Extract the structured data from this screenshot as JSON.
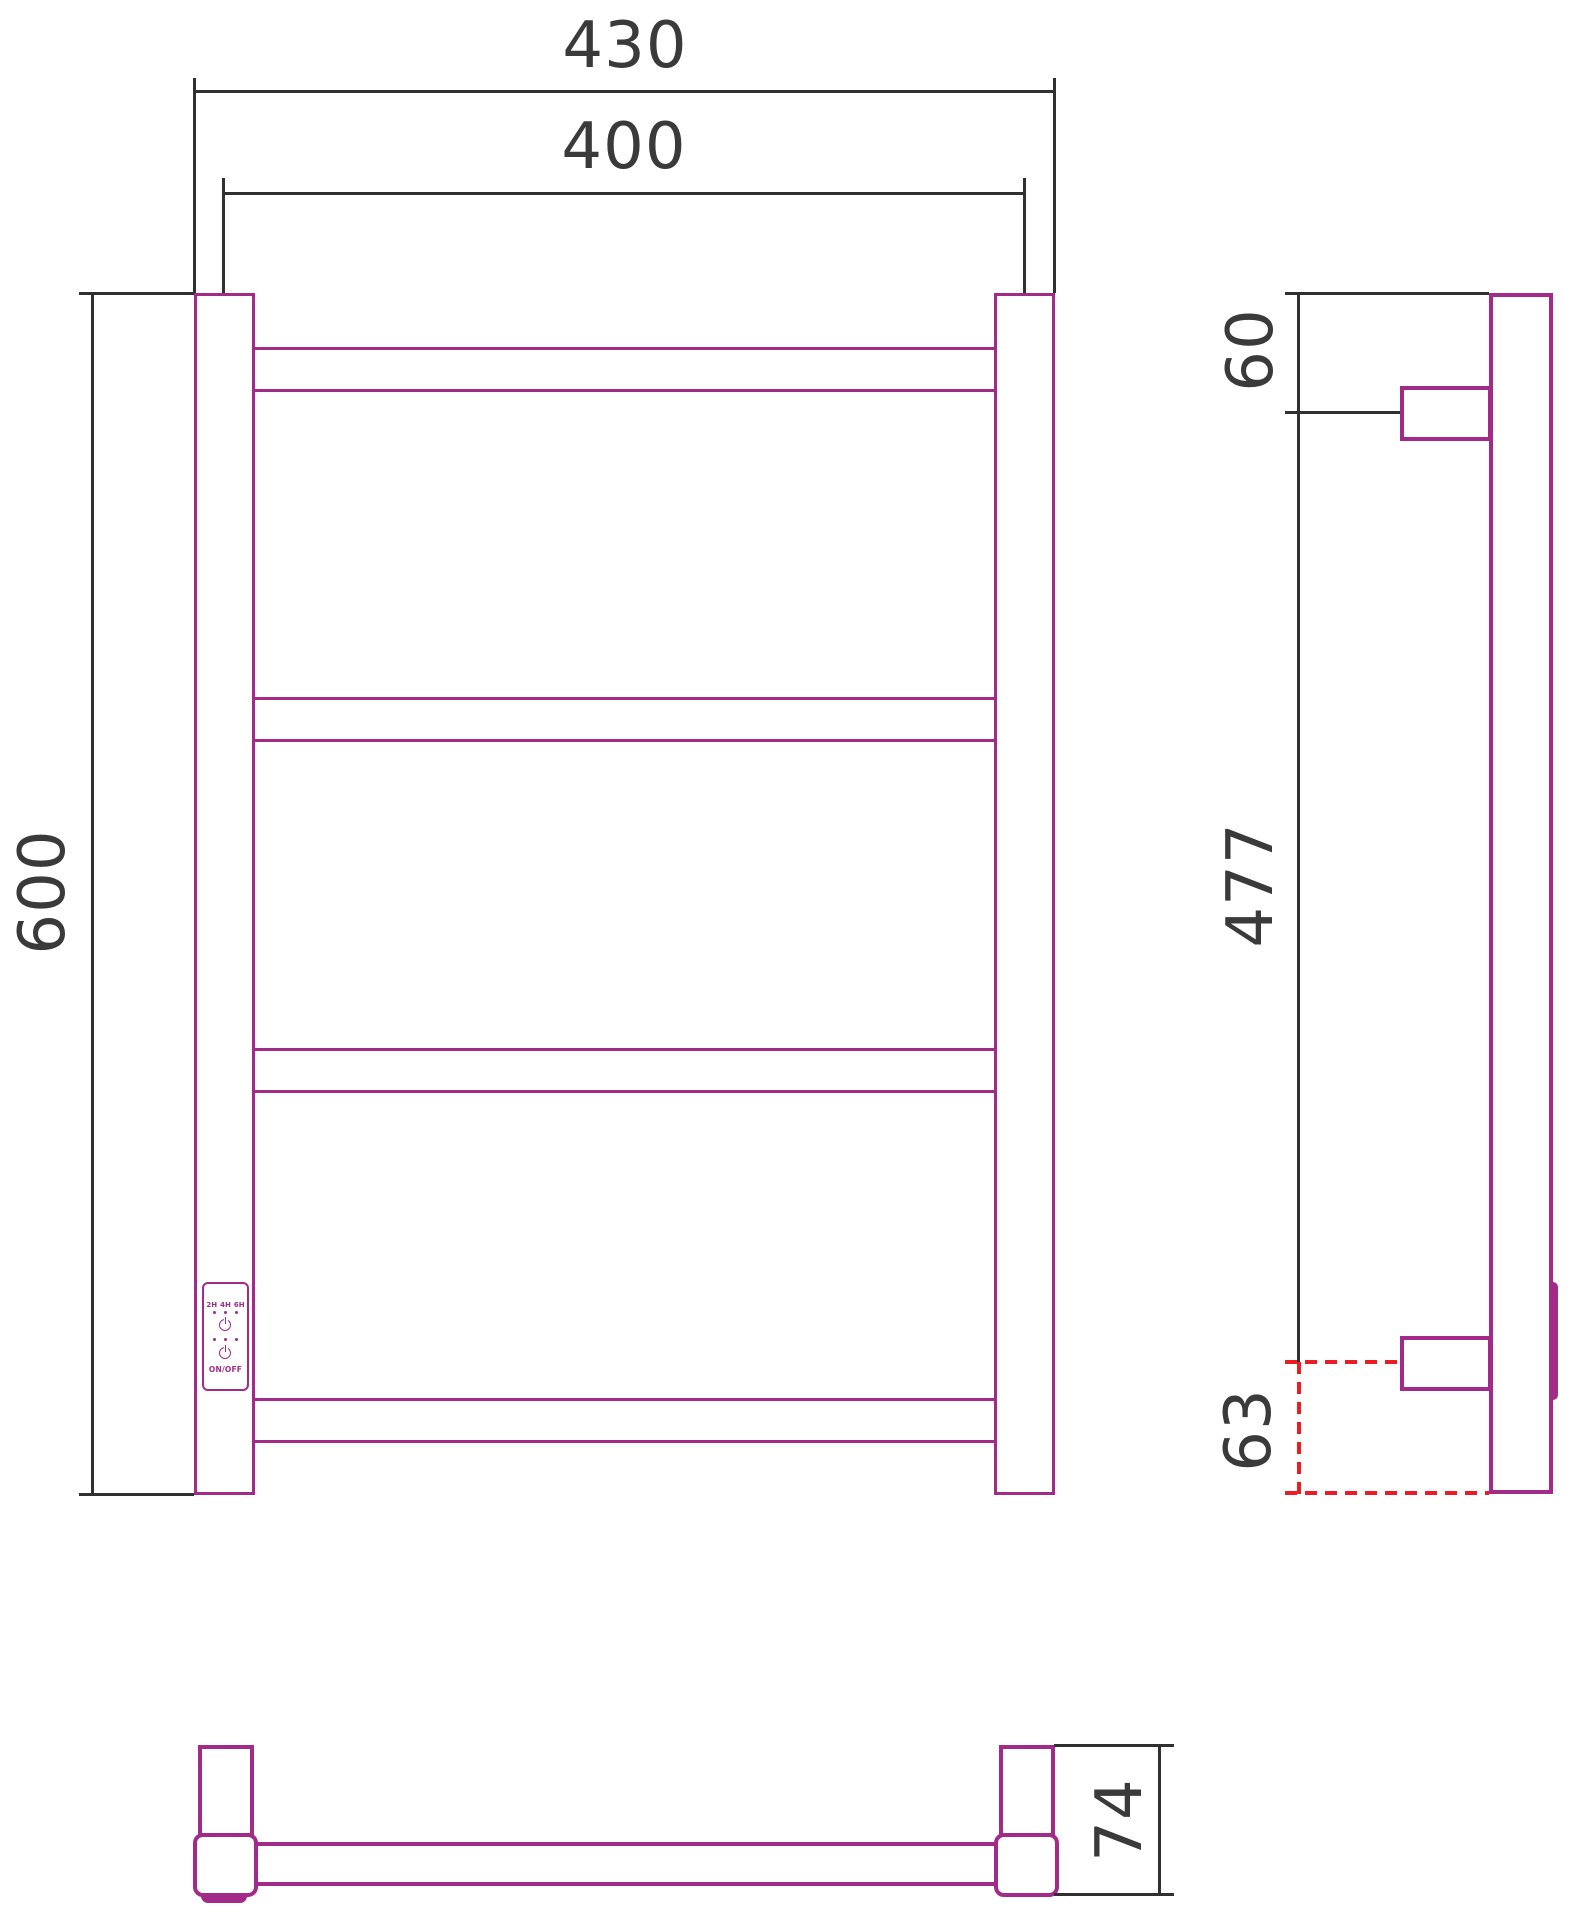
{
  "drawing": {
    "type": "technical-dimension-drawing",
    "subject": "ladder towel rail with electric control panel, three orthographic views"
  },
  "colors": {
    "product_magenta": "#A22B8A",
    "dimension_black": "#303030",
    "text_gray": "#3A3A3A",
    "hidden_line_red": "#EC1C24"
  },
  "views": {
    "front": {
      "dims": {
        "outer_width": "430",
        "axis_width": "400",
        "height": "600"
      },
      "control_panel": {
        "timer_labels": [
          "2H",
          "4H",
          "6H"
        ],
        "onoff_label": "ON/OFF",
        "power_icon": "power-icon",
        "led_icon": "led-dot-icon"
      }
    },
    "side": {
      "dims": {
        "top_to_bracket": "60",
        "bracket_to_bracket": "477",
        "bracket_to_bottom": "63"
      }
    },
    "bottom": {
      "dims": {
        "depth": "74"
      }
    }
  }
}
